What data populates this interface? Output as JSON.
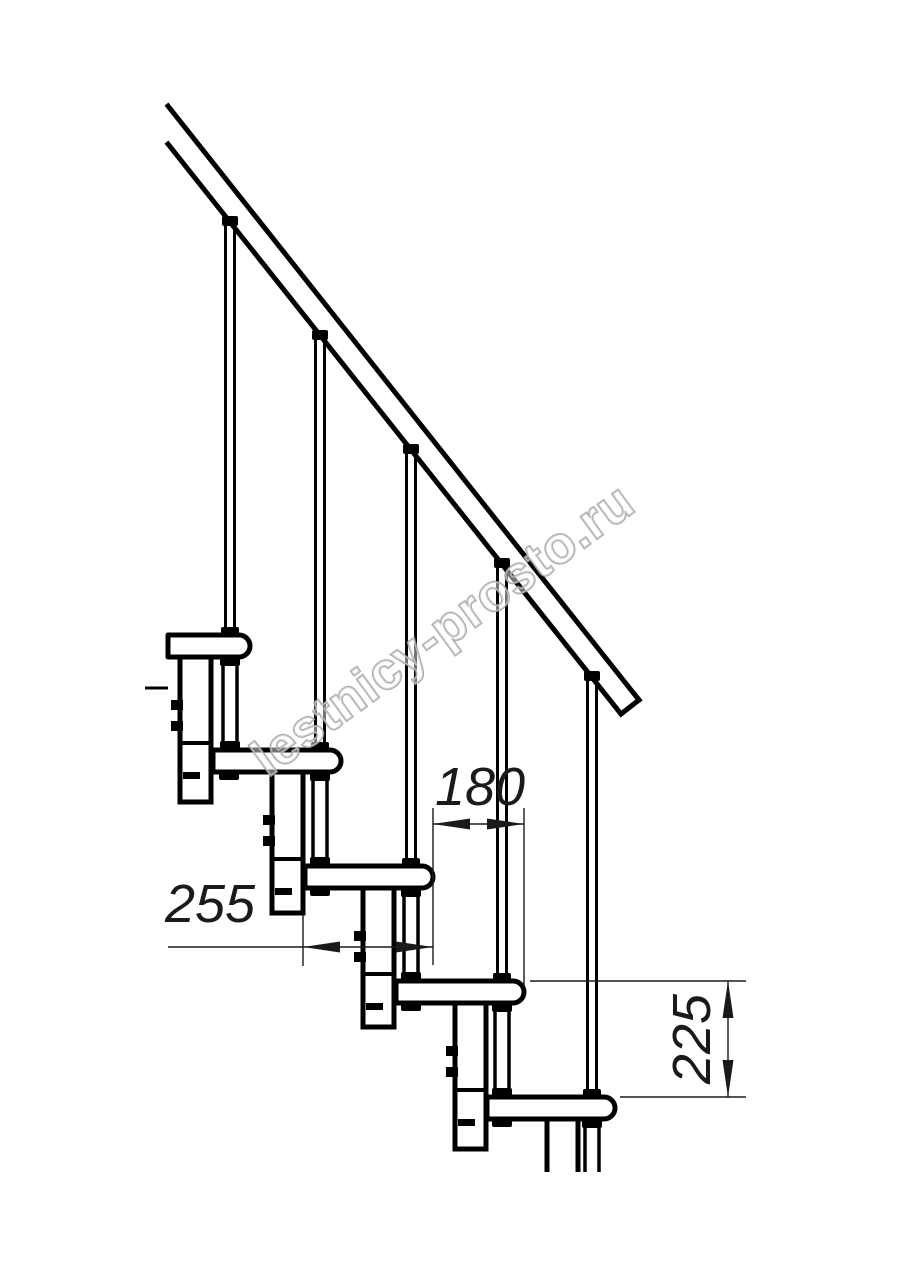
{
  "drawing": {
    "kind": "staircase-side-view-line-drawing"
  },
  "dimensions": {
    "going": "180",
    "tread_depth": "255",
    "rise": "225"
  },
  "watermark": {
    "text": "lestnicy-prosto.ru"
  },
  "colors": {
    "line": "#000000",
    "dimension": "#1a1a1a",
    "watermark_outline": "#9c9c9c"
  }
}
